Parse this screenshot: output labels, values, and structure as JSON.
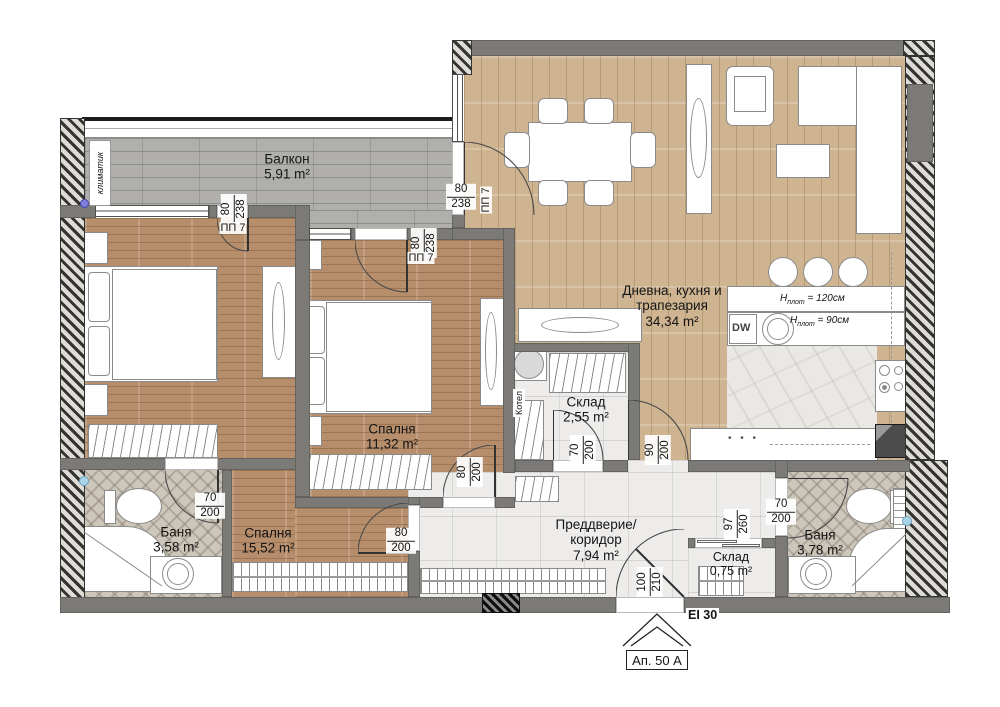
{
  "rooms": [
    {
      "name": "Балкон",
      "area": "5,91 m²"
    },
    {
      "name": "Дневна, кухня и\nтрапезария",
      "area": "34,34 m²"
    },
    {
      "name": "Спалня",
      "area": "11,32 m²"
    },
    {
      "name": "Спалня",
      "area": "15,52 m²"
    },
    {
      "name": "Баня",
      "area": "3,58 m²"
    },
    {
      "name": "Баня",
      "area": "3,78 m²"
    },
    {
      "name": "Склад",
      "area": "2,55 m²"
    },
    {
      "name": "Склад",
      "area": "0,75 m²"
    },
    {
      "name": "Преддверие/\nкоридор",
      "area": "7,94 m²"
    }
  ],
  "door_tag": "ПП 7",
  "door_dims": [
    {
      "id": "balcony-door-bedroom-left",
      "w": "80",
      "h": "238"
    },
    {
      "id": "balcony-door-bedroom-mid",
      "w": "80",
      "h": "238"
    },
    {
      "id": "balcony-door-living",
      "w": "80",
      "h": "238"
    },
    {
      "id": "bedroom-mid-corridor-door",
      "w": "80",
      "h": "200"
    },
    {
      "id": "bedroom-left-corridor-door",
      "w": "80",
      "h": "200"
    },
    {
      "id": "bath-left-door",
      "w": "70",
      "h": "200"
    },
    {
      "id": "storage-large-door",
      "w": "70",
      "h": "200"
    },
    {
      "id": "living-corridor-door",
      "w": "90",
      "h": "200"
    },
    {
      "id": "storage-small-opening",
      "w": "97",
      "h": "260"
    },
    {
      "id": "entrance-door",
      "w": "100",
      "h": "210"
    },
    {
      "id": "bath-right-door",
      "w": "70",
      "h": "200"
    }
  ],
  "annotations": {
    "ac_unit": "климатик",
    "boiler": "Котел",
    "dishwasher": "DW",
    "h_sym": "H",
    "h_sub": "плот",
    "h_bar": "= 120см",
    "h_work": "= 90см",
    "cabinet_handles": "• • •",
    "fire_rating": "EI 30",
    "apartment": "Ап. 50 A"
  },
  "colors": {
    "wall_gray": "#7b7a77",
    "living_floor": "#cfb491",
    "bedroom_floor": "#b68e6b",
    "balcony_deck": "#b0afac",
    "marble": "#edecea",
    "chevron_tile": "#cdc6ba",
    "dot_purple": "#8080e0",
    "dot_blue": "#a9d3e6"
  }
}
